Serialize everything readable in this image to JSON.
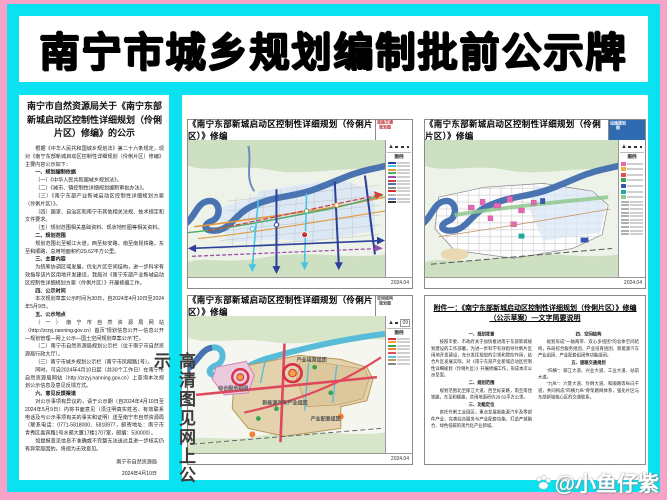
{
  "page": {
    "title": "南宁市城乡规划编制批前公示牌"
  },
  "colors": {
    "border_pink": "#f6a3c7",
    "frame_cyan": "#0be2f1",
    "river_blue": "#4a73b2",
    "zone_blue": "#d8e6f4",
    "land_green": "#cde0c2",
    "structure_beige": "#e3d2ac",
    "structure_pink": "#eccade",
    "axis_red": "#e0485e"
  },
  "notice": {
    "title": "南宁市自然资源局关于《南宁东部新城启动区控制性详细规划（伶俐片区）修编》的公示",
    "paragraphs": [
      {
        "t": "根据《中华人民共和国城乡规划法》第二十六条规定，现对《南宁东部新城启动区控制性详细规划（伶俐片区）修编》主要内容公示如下："
      },
      {
        "h": true,
        "t": "一、规划编制依据"
      },
      {
        "t": "（一）《中华人民共和国城乡规划法》。"
      },
      {
        "t": "（二）《城市、镇控制性详细规划编制审批办法》。"
      },
      {
        "t": "（三）《南宁东部产业新城启动区控制性详细规划方案（伶俐片区）》。"
      },
      {
        "t": "（四）国家、自治区和南宁市其他相关法规、技术规定和文件要求。"
      },
      {
        "t": "（五）规划范围相关基础资料、现状地形图等相关资料。"
      },
      {
        "h": true,
        "t": "二、规划范围"
      },
      {
        "t": "规划范围北至郁江大道，西至标安路，南至南昆铁路，东至和顺路，总用地面积约29.62平方公里。"
      },
      {
        "h": true,
        "t": "三、主要内容"
      },
      {
        "t": "为统筹协调区域发展，优化片区空间结构，进一步科学有效指导该片区用地开发建设，我局对《南宁东部产业新城启动区控制性详细规划方案（伶俐片区）》开展修编工作。"
      },
      {
        "h": true,
        "t": "四、公示时间"
      },
      {
        "t": "本次规划草案公示时间为30日，自2024年4月10日至2024年5月9日。"
      },
      {
        "h": true,
        "t": "五、公示地点"
      },
      {
        "t": "（一）南宁市自然资源局网站（http://zrzyj.nanning.gov.cn）首页“规划信息公开—信息公开—规划管理—网上公示—国土空间规划草案公示”栏。"
      },
      {
        "t": "（二）南宁市自然资源局规划公示栏（位于南宁市自然资源局行政大厅）。"
      },
      {
        "t": "（三）南宁市城乡规划公示栏（南宁市凤翔路1号）。"
      },
      {
        "t": "同时，可自2024年4月10日起（共30个工作日）在南宁市自然资源局网站（http://zrzyj.nanning.gov.cn）上查询本次规划公示信息及意见反馈方式。"
      },
      {
        "h": true,
        "t": "六、意见反馈渠道"
      },
      {
        "t": "对公示事项有异议的，请于公示期（自2024年4月10日至2024年5月9日）内将书面意见（须注明真实姓名、有效联系电话及与公示事项有关的事实和证明）送至南宁市自然资源局（联系电话：0771-5818000、5818977，邮寄地址：南宁市青秀区嘉宾路1号水邮大厦17楼1707室，邮编：530000）。"
      },
      {
        "t": "如提报意见信息不准确或不完整无法送达且进一步核实仍有异常原因的，将视为无效意见。"
      }
    ],
    "signature": "南宁市自然资源局",
    "date": "2024年4月10日"
  },
  "panels": {
    "road": {
      "title": "《南宁东部新城启动区控制性详细规划（伶俐片区）》修编",
      "tag": "道路交通规划图",
      "legend_title": "图例",
      "date": "2024.04",
      "legend_colors": [
        "#2c3f9a",
        "#47c6e4",
        "#e29a3e",
        "#55a868",
        "#9a50a8",
        "#cc4040",
        "#4a73b2",
        "#888888",
        "#d03030",
        "#b8b8b8",
        "#6b8fc4",
        "#333333"
      ]
    },
    "facility": {
      "title": "《南宁东部新城启动区控制性详细规划（伶俐片区）》修编",
      "tag": "公共服务设施规划图",
      "legend_title": "图例",
      "date": "2024.04",
      "legend_colors_sq": [
        "#e468b4",
        "#f0b040",
        "#e05050",
        "#3aa353",
        "#3a55b0",
        "#22a8a0",
        "#8fc88f"
      ],
      "legend_colors_ln": [
        "#b0b0b0",
        "#b0b0b0",
        "#b0b0b0",
        "#b0b0b0",
        "#b0b0b0",
        "#b0b0b0",
        "#b0b0b0",
        "#b0b0b0",
        "#b0b0b0",
        "#b0b0b0"
      ]
    },
    "structure": {
      "title": "《南宁东部新城启动区控制性详细规划（伶俐片区）》修编",
      "tag": "空间结构规划图",
      "legend_title": "图例",
      "date": "2024.04",
      "sheet_no": "09",
      "legend_colors": [
        "#d63048",
        "#f4a23c",
        "#3aa353",
        "#f08032",
        "#e0485e",
        "#5bc4dc",
        "#b89858",
        "#888888"
      ],
      "labels": {
        "a": "综合服务组团",
        "b": "产业培育组团",
        "c": "新能源汽车产业组团",
        "d": "产业配套组团"
      }
    },
    "attachment": {
      "title": "附件一：《南宁东部新城启动区控制性详细规划（伶俐片区）》修编（公示草案）—文字简要说明",
      "col1": [
        {
          "h": true,
          "t": "一、规划背景"
        },
        {
          "t": "按照市委、市政府关于加快推进南宁东部新城规划建设的工作部署，为进一步科学有效指导伶俐片区用地开发建设，充分发挥规划的引领和管控作用，结合片区发展实际，对《南宁东部产业新城启动区控制性详细规划（伶俐片区）》开展修编工作，形成本次公示草案。"
        },
        {
          "h": true,
          "t": "二、规划范围"
        },
        {
          "t": "规划范围北至郁江大道，西至标安路，南至南昆铁路，东至和顺路，总用地面积约29.62平方公里。"
        },
        {
          "h": true,
          "t": "三、功能定位"
        },
        {
          "t": "依托伶俐工业园区，重点发展新能源汽车及零部件产业，完善综合服务与产业配套功能，打造产城融合、绿色低碳的现代化产业新城。"
        }
      ],
      "col2": [
        {
          "h": true,
          "t": "四、空间结构"
        },
        {
          "t": "规划形成“一轴两带、双心多组团”的总体空间结构，布局综合服务组团、产业培育组团、新能源汽车产业组团、产业配套组团等功能组团。"
        },
        {
          "h": true,
          "t": "五、道路交通规划"
        },
        {
          "t": "“四横”：郁江大道、兴业大道、工业大道、站前大道。"
        },
        {
          "t": "“九纵”：六景大道、伶俐大道、和顺路等纵向干道，共同构成“四横九纵”骨架路网体系，强化片区与东部新城核心区的交通联系。"
        }
      ]
    }
  },
  "watermarks": {
    "vertical": "高清图见网上公示",
    "credit": "@小鱼仔紫"
  }
}
